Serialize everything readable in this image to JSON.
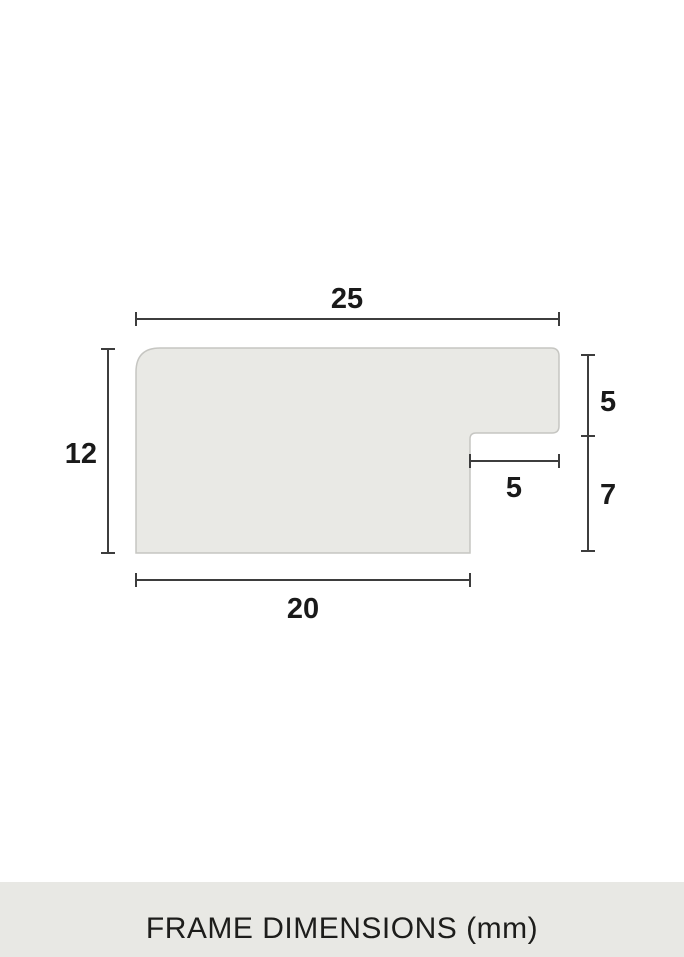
{
  "diagram": {
    "type": "frame-profile-cross-section",
    "unit": "mm",
    "labels": {
      "top_width": "25",
      "left_height": "12",
      "right_upper_height": "5",
      "notch_width": "5",
      "right_lower_height": "7",
      "bottom_width": "20"
    }
  },
  "caption": {
    "label": "FRAME DIMENSIONS (mm)"
  },
  "colors": {
    "background": "#ffffff",
    "shape_fill": "#e9e9e5",
    "shape_stroke": "#c6c6c2",
    "dimension_line": "#3d3d3d",
    "number_text": "#1a1a1a",
    "caption_bar_background": "#e8e8e4",
    "caption_text": "#1d1d1b"
  }
}
